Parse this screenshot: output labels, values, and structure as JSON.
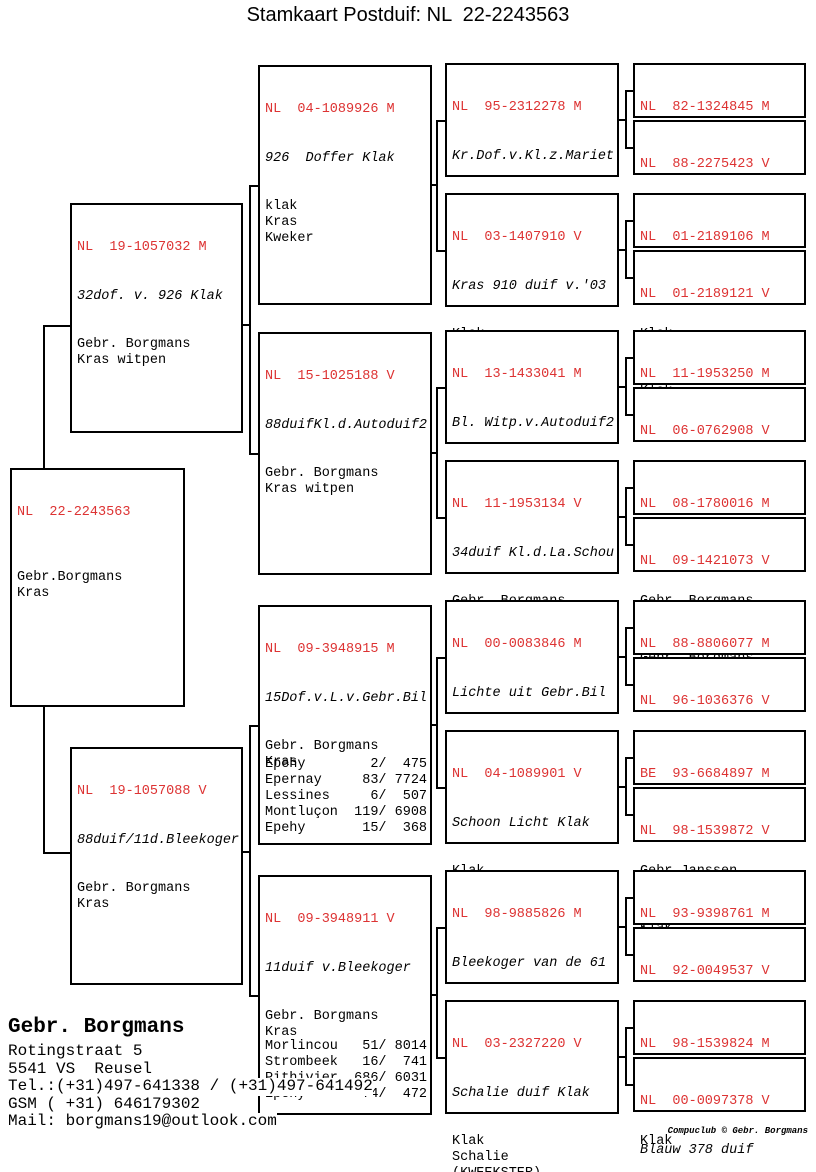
{
  "title": "Stamkaart Postduif: NL  22-2243563",
  "colors": {
    "ring_red": "#dd3333",
    "line_black": "#000000"
  },
  "boxes": {
    "subject": {
      "ring": "NL  22-2243563",
      "info": [
        "",
        "Gebr.Borgmans",
        "Kras"
      ]
    },
    "pm": {
      "ring": "NL  19-1057032 M",
      "name": "32dof. v. 926 Klak",
      "info": [
        "Gebr. Borgmans",
        "Kras witpen"
      ]
    },
    "pv": {
      "ring": "NL  19-1057088 V",
      "name": "88duif/11d.Bleekoger",
      "info": [
        "Gebr. Borgmans",
        "Kras"
      ]
    },
    "gp1": {
      "ring": "NL  04-1089926 M",
      "name": "926  Doffer Klak",
      "info": [
        "klak",
        "Kras",
        "Kweker"
      ]
    },
    "gp2": {
      "ring": "NL  15-1025188 V",
      "name": "88duifKl.d.Autoduif2",
      "info": [
        "Gebr. Borgmans",
        "Kras witpen"
      ]
    },
    "gp3": {
      "ring": "NL  09-3948915 M",
      "name": "15Dof.v.L.v.Gebr.Bil",
      "info": [
        "Gebr. Borgmans",
        "Kras"
      ],
      "races": [
        "Epehy        2/  475",
        "Epernay     83/ 7724",
        "Lessines     6/  507",
        "Montluçon  119/ 6908",
        "Epehy       15/  368"
      ]
    },
    "gp4": {
      "ring": "NL  09-3948911 V",
      "name": "11duif v.Bleekoger",
      "info": [
        "Gebr. Borgmans",
        "Kras"
      ],
      "races": [
        "Morlincou   51/ 8014",
        "Strombeek   16/  741",
        "Pithivier  686/ 6031",
        "Epehy       74/  472"
      ]
    },
    "ggp1": {
      "ring": "NL  95-2312278 M",
      "name": "Kr.Dof.v.Kl.z.Mariet",
      "info": [
        "Klak",
        "Kras"
      ]
    },
    "ggp2": {
      "ring": "NL  03-1407910 V",
      "name": "Kras 910 duif v.'03",
      "info": [
        "Klak",
        "Kras"
      ]
    },
    "ggp3": {
      "ring": "NL  13-1433041 M",
      "name": "Bl. Witp.v.Autoduif2",
      "info": [
        "Gebr. Borgmans",
        "Blauw",
        "Kweker"
      ]
    },
    "ggp4": {
      "ring": "NL  11-1953134 V",
      "name": "34duif Kl.d.La.Schou",
      "info": [
        "Gebr. Borgmans",
        "Kras"
      ]
    },
    "ggp5": {
      "ring": "NL  00-0083846 M",
      "name": "Lichte uit Gebr.Bil",
      "info": [
        "Gebr. Borgmans",
        "Kras",
        "Kl.zoon 613 Klak"
      ]
    },
    "ggp6": {
      "ring": "NL  04-1089901 V",
      "name": "Schoon Licht Klak",
      "info": [
        "Klak",
        "Kras",
        "(KWEEKSTER)"
      ]
    },
    "ggp7": {
      "ring": "NL  98-9885826 M",
      "name": "Bleekoger van de 61",
      "info": [
        "1epr.NAT.LaSouterain",
        "Kras",
        "1e pr. NAT NPO",
        "La Souteraine Afd.3"
      ]
    },
    "ggp8": {
      "ring": "NL  03-2327220 V",
      "name": "Schalie duif Klak",
      "info": [
        "Klak",
        "Schalie",
        "(KWEEKSTER)"
      ]
    },
    "g1": {
      "ring": "NL  82-1324845 M",
      "name": "Kl.ZoonMarietje Klak",
      "info": [
        "Klak"
      ]
    },
    "g2": {
      "ring": "NL  88-2275423 V",
      "name": "Bl 23 duif '89 14 pr",
      "info": [
        "Klak"
      ]
    },
    "g3": {
      "ring": "NL  01-2189106 M",
      "name": "Blauwe 106 in'01 9pr",
      "info": [
        "Klak"
      ]
    },
    "g4": {
      "ring": "NL  01-2189121 V",
      "name": "Kras 121duif '01 9pr",
      "info": [
        "Klak"
      ]
    },
    "g5": {
      "ring": "NL  11-1953250 M",
      "name": "Bl.50dof.v. Li.v.613",
      "info": [
        "Gebr. Borgmans"
      ]
    },
    "g6": {
      "ring": "NL  06-0762908 V",
      "name": "Autoduif2NAT.Orleans",
      "info": [
        "Gebr. Borgmans"
      ]
    },
    "g7": {
      "ring": "NL  08-1780016 M",
      "name": "16Dof.v.LateSchouwma",
      "info": [
        "Gebr. Borgmans"
      ]
    },
    "g8": {
      "ring": "NL  09-1421073 V",
      "name": "73duif v.Sch.D.v.25",
      "info": [
        "Gebr. Borgmans"
      ]
    },
    "g9": {
      "ring": "NL  88-8806077 M",
      "name": "Gebroken Bil",
      "info": [
        "Gebr. Borgmans"
      ]
    },
    "g10": {
      "ring": "NL  96-1036376 V",
      "name": "Licht uit 613 Klak",
      "info": [
        "Klak"
      ]
    },
    "g11": {
      "ring": "BE  93-6684897 M",
      "name": "897 Doffer Janssen",
      "info": [
        "Gebr.Janssen."
      ]
    },
    "g12": {
      "ring": "NL  98-1539872 V",
      "name": "Blauw duif v.d. 613",
      "info": [
        "Klak"
      ]
    },
    "g13": {
      "ring": "NL  93-9398761 M",
      "name": "61 Doffer uit Beer",
      "info": [
        "Gebr. Borgmans"
      ]
    },
    "g14": {
      "ring": "NL  92-0049537 V",
      "name": "Donk.oogje v.Late613",
      "info": [
        "Gebr. Borgmans"
      ]
    },
    "g15": {
      "ring": "NL  98-1539824 M",
      "name": "Kras 824 '98 10 pr.",
      "info": [
        "Klak"
      ]
    },
    "g16": {
      "ring": "NL  00-0097378 V",
      "name": "Blauw 378 duif",
      "info": [
        "Gebr. Borgmans"
      ]
    }
  },
  "owner": {
    "name": "Gebr. Borgmans",
    "street": "Rotingstraat 5",
    "city": "5541 VS  Reusel",
    "tel": "Tel.:(+31)497-641338 / (+31)497-641492",
    "gsm": "GSM ( +31) 646179302",
    "mail": "Mail: borgmans19@outlook.com"
  },
  "footer": "Compuclub © Gebr. Borgmans"
}
